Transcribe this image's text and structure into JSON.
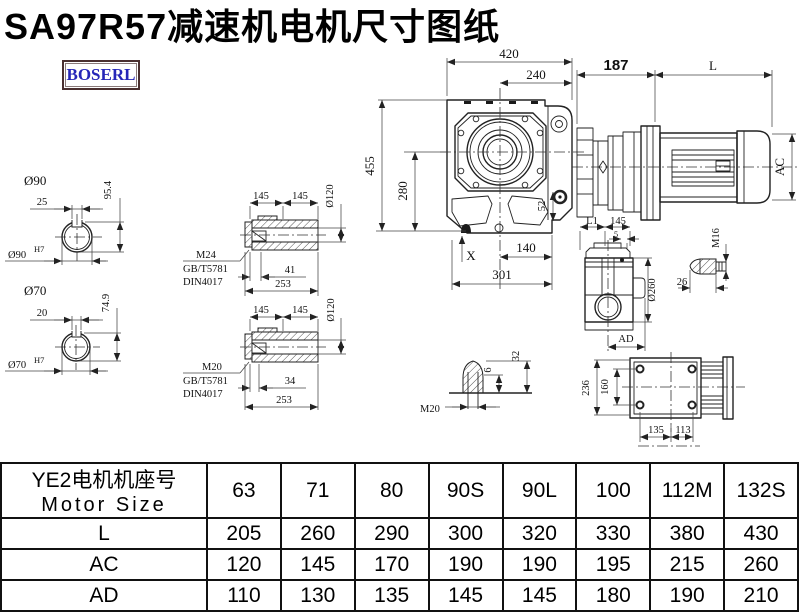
{
  "title": "SA97R57减速机电机尺寸图纸",
  "logo": "BOSERL",
  "views": {
    "front": {
      "w420": "420",
      "w240": "240",
      "h455": "455",
      "h280": "280",
      "d52": "52",
      "x": "X",
      "w140": "140",
      "w301": "301"
    },
    "motor": {
      "d187": "187",
      "l": "L",
      "ac": "AC"
    },
    "sec90": {
      "dia": "Ø90",
      "kw": "25",
      "kh": "95.4",
      "fit": "Ø90",
      "fit_tol": "H7"
    },
    "sec70": {
      "dia": "Ø70",
      "kw": "20",
      "kh": "74.9",
      "fit": "Ø70",
      "fit_tol": "H7"
    },
    "hollow1": {
      "l145a": "145",
      "l145b": "145",
      "dia": "Ø120",
      "thread": "M24",
      "std1": "GB/T5781",
      "std2": "DIN4017",
      "depth": "41",
      "len": "253"
    },
    "hollow2": {
      "l145a": "145",
      "l145b": "145",
      "dia": "Ø120",
      "thread": "M20",
      "std1": "GB/T5781",
      "std2": "DIN4017",
      "depth": "34",
      "len": "253"
    },
    "stud": {
      "thread": "M20",
      "d6": "6",
      "d32": "32"
    },
    "side": {
      "l1": "L1",
      "d145": "145",
      "d5": "5",
      "dia": "Ø260",
      "ad": "AD"
    },
    "bolt": {
      "thread": "M16",
      "d26": "26"
    },
    "top": {
      "d236": "236",
      "d160": "160",
      "d135": "135",
      "d113": "113"
    }
  },
  "table": {
    "header_line1": "YE2电机机座号",
    "header_line2": "Motor Size",
    "sizes": [
      "63",
      "71",
      "80",
      "90S",
      "90L",
      "100",
      "112M",
      "132S"
    ],
    "rows": [
      {
        "label": "L",
        "values": [
          "205",
          "260",
          "290",
          "300",
          "320",
          "330",
          "380",
          "430"
        ]
      },
      {
        "label": "AC",
        "values": [
          "120",
          "145",
          "170",
          "190",
          "190",
          "195",
          "215",
          "260"
        ]
      },
      {
        "label": "AD",
        "values": [
          "110",
          "130",
          "135",
          "145",
          "145",
          "180",
          "190",
          "210"
        ]
      }
    ]
  }
}
